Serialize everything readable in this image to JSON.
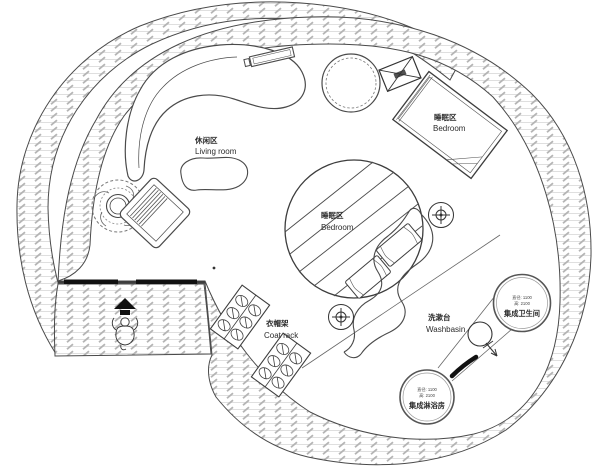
{
  "drawing": {
    "type": "architectural-floor-plan",
    "areas": {
      "living_room": {
        "label_zh": "休闲区",
        "label_en": "Living room"
      },
      "bedroom_upper": {
        "label_zh": "睡眠区",
        "label_en": "Bedroom"
      },
      "bedroom_center": {
        "label_zh": "睡眠区",
        "label_en": "Bedroom"
      },
      "coat_rack": {
        "label_zh": "衣帽架",
        "label_en": "Coat rack"
      },
      "washbasin": {
        "label_zh": "洗漱台",
        "label_en": "Washbasin"
      },
      "bathroom_pod": {
        "dim_line1": "直径: 1100",
        "dim_line2": "高: 2100",
        "name_zh": "集成卫生间"
      },
      "shower_pod": {
        "dim_line1": "直径: 1100",
        "dim_line2": "高: 2100",
        "name_zh": "集成淋浴房"
      }
    },
    "icons": {
      "entry_arrow": "entry-direction-arrow",
      "person": "person-figure",
      "survey_marker": "crosshair-target",
      "ac_unit": "crossed-box-vent",
      "toilet": "toilet-swing-symbol",
      "door_marker": "black-door-stroke",
      "plant": "potted-plant"
    },
    "colors": {
      "line": "#4a4a4a",
      "hatch_light": "#cfcfcf",
      "hatch_dash": "#b5b5b5",
      "solid_black": "#111111",
      "background": "#ffffff",
      "text": "#2b2b2b"
    }
  }
}
